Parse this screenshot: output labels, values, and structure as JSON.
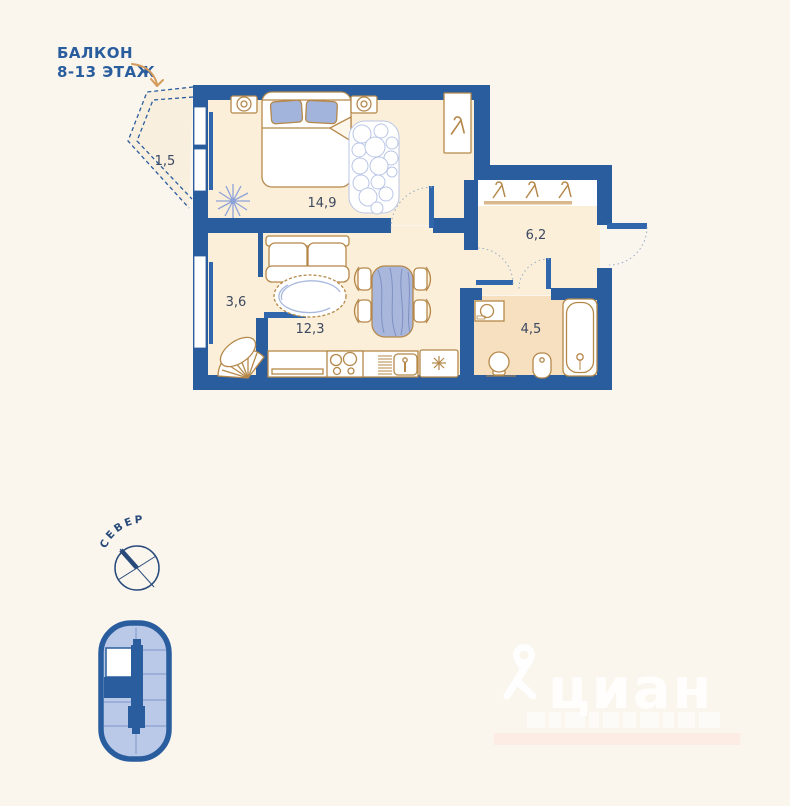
{
  "annotation": {
    "balcony_line1": "БАЛКОН",
    "balcony_line2": "8-13 ЭТАЖ"
  },
  "rooms": {
    "balcony": "1,5",
    "bedroom": "14,9",
    "nook": "3,6",
    "living_kitchen": "12,3",
    "hallway": "6,2",
    "bathroom": "4,5"
  },
  "compass": {
    "label": "СЕВЕР"
  },
  "watermark": {
    "brand": "циан"
  },
  "icons": {
    "balcony_arrow": "curved-arrow",
    "compass": "compass-rose",
    "building_position": "building-footprint-with-unit-highlight",
    "closet_hangers": "clothes-hanger",
    "fridge": "snowflake",
    "plant": "houseplant"
  },
  "colors": {
    "background": "#faf6ee",
    "wall": "#2a5d9e",
    "floor": "#fbefd9",
    "bathroom_floor": "#f6e0bf",
    "furniture_outline": "#b5884a",
    "accent_blue": "#a9b7dc",
    "door_leaf": "#2f66ac",
    "label_text": "#3c4960",
    "annotation_text": "#2a5d9e",
    "arrow": "#d49c5c"
  }
}
